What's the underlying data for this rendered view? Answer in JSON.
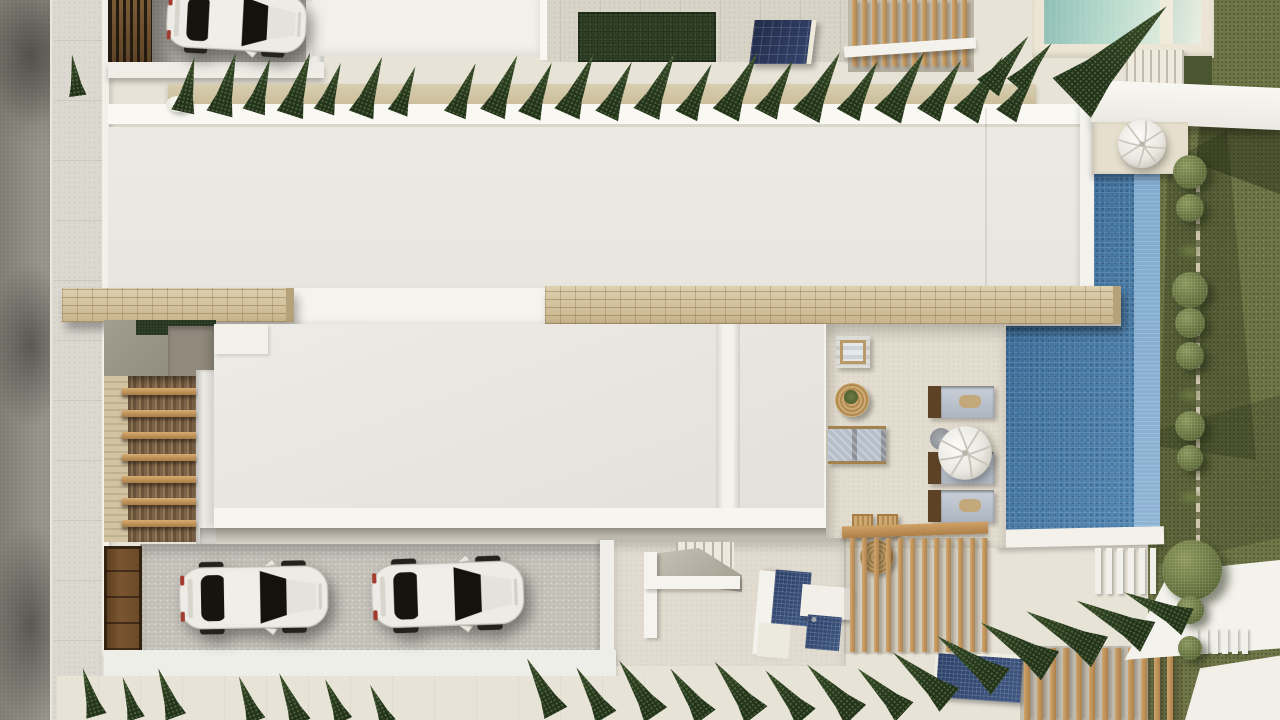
{
  "scene_type": "aerial-architectural-render",
  "palette": {
    "cream": "#e8e3d7",
    "road": "#8d8a81",
    "sidewalk": "#dcd9d1",
    "white": "#f5f3ee",
    "roof": "#ebe9e3",
    "parapet": "#f9f8f4",
    "stone": "#d9cca9",
    "stoneLine": "#a98e66",
    "wood": "#c89e68",
    "pool": "#4a7ba9",
    "poolLight": "#7fa9cd",
    "poolTop": "#b7dacd",
    "lawn": "#6e7546",
    "lawnDark": "#4b5630",
    "turf": "#33432a",
    "cypress": "#2c3f21",
    "bush": "#5f6c3a",
    "solar": "#283457",
    "glass": "#17150f",
    "carBody": "#edebe6",
    "mosaicDark": "#32486f",
    "floorA": "#c7c4bc",
    "floorB": "#b7b4ac",
    "terra": "#e3ddcf"
  },
  "inventory": {
    "cars_white": 3,
    "pools": 2,
    "spa_water_features": 2,
    "sun_loungers": 3,
    "closed_umbrellas": 2,
    "pergolas": 3,
    "cypress_trees_top": 26,
    "cypress_trees_bottom": 21,
    "round_bushes": 10
  },
  "road_shadows": [
    {
      "y": "-20px",
      "h": "150px"
    },
    {
      "y": "260px",
      "h": "170px"
    },
    {
      "y": "520px",
      "h": "210px"
    }
  ],
  "sidewalk_lines": [
    {
      "y": "40px"
    },
    {
      "y": "100px"
    },
    {
      "y": "160px"
    },
    {
      "y": "220px"
    },
    {
      "y": "280px"
    },
    {
      "y": "340px"
    },
    {
      "y": "400px"
    },
    {
      "y": "460px"
    },
    {
      "y": "520px"
    },
    {
      "y": "580px"
    },
    {
      "y": "640px"
    },
    {
      "y": "700px"
    }
  ],
  "garage_slats": [
    {
      "x": "112px"
    },
    {
      "x": "119px"
    },
    {
      "x": "126px"
    },
    {
      "x": "133px"
    },
    {
      "x": "140px"
    },
    {
      "x": "147px"
    }
  ],
  "courtyard_tiles": [
    {
      "x": "560px"
    },
    {
      "x": "600px"
    },
    {
      "x": "640px"
    },
    {
      "x": "680px"
    },
    {
      "x": "720px"
    },
    {
      "x": "760px"
    },
    {
      "x": "800px"
    },
    {
      "x": "840px"
    }
  ],
  "slats_pergola_top": [
    {
      "x": "852px"
    },
    {
      "x": "862px"
    },
    {
      "x": "872px"
    },
    {
      "x": "882px"
    },
    {
      "x": "892px"
    },
    {
      "x": "902px"
    },
    {
      "x": "912px"
    },
    {
      "x": "922px"
    },
    {
      "x": "932px"
    },
    {
      "x": "942px"
    },
    {
      "x": "952px"
    },
    {
      "x": "962px"
    }
  ],
  "beams_left": [
    {
      "y": "388px"
    },
    {
      "y": "410px"
    },
    {
      "y": "432px"
    },
    {
      "y": "454px"
    },
    {
      "y": "476px"
    },
    {
      "y": "498px"
    },
    {
      "y": "520px"
    }
  ],
  "loungers": [
    {
      "y": "386px"
    },
    {
      "y": "452px"
    },
    {
      "y": "490px"
    }
  ],
  "baskets": [
    {
      "x": "852px"
    },
    {
      "x": "877px"
    }
  ],
  "gate_planks": [
    {
      "y": "570px"
    },
    {
      "y": "596px"
    },
    {
      "y": "622px"
    },
    {
      "y": "648px"
    }
  ],
  "cars": [
    {
      "x": "168px",
      "y": "558px",
      "w": "168px",
      "r": "-1deg"
    },
    {
      "x": "360px",
      "y": "554px",
      "w": "172px",
      "r": "-2deg"
    },
    {
      "x": "156px",
      "y": "-16px",
      "w": "158px",
      "r": "3deg"
    }
  ],
  "umbrellas": [
    {
      "x": "936px",
      "y": "424px",
      "s": "58px",
      "r": "-15deg"
    },
    {
      "x": "1116px",
      "y": "118px",
      "s": "52px",
      "r": "10deg"
    }
  ],
  "slats_pergola_bottom": [
    {
      "x": "850px"
    },
    {
      "x": "862px"
    },
    {
      "x": "874px"
    },
    {
      "x": "886px"
    },
    {
      "x": "898px"
    },
    {
      "x": "910px"
    },
    {
      "x": "922px"
    },
    {
      "x": "934px"
    },
    {
      "x": "946px"
    },
    {
      "x": "958px"
    },
    {
      "x": "970px"
    },
    {
      "x": "982px"
    }
  ],
  "slats_fence": [
    {
      "x": "1024px"
    },
    {
      "x": "1037px"
    },
    {
      "x": "1050px"
    },
    {
      "x": "1063px"
    },
    {
      "x": "1076px"
    },
    {
      "x": "1089px"
    },
    {
      "x": "1102px"
    },
    {
      "x": "1115px"
    },
    {
      "x": "1128px"
    },
    {
      "x": "1141px"
    },
    {
      "x": "1154px"
    },
    {
      "x": "1167px"
    }
  ],
  "balusters_a": [
    {
      "x": "1095px"
    },
    {
      "x": "1106px"
    },
    {
      "x": "1117px"
    },
    {
      "x": "1128px"
    },
    {
      "x": "1139px"
    },
    {
      "x": "1150px"
    }
  ],
  "balusters_b": [
    {
      "x": "1192px"
    },
    {
      "x": "1202px"
    },
    {
      "x": "1212px"
    },
    {
      "x": "1222px"
    },
    {
      "x": "1232px"
    },
    {
      "x": "1242px"
    }
  ],
  "bushes": [
    {
      "y": "172px",
      "d": "34px"
    },
    {
      "y": "208px",
      "d": "28px"
    },
    {
      "y": "290px",
      "d": "36px"
    },
    {
      "y": "323px",
      "d": "30px"
    },
    {
      "y": "356px",
      "d": "28px"
    },
    {
      "y": "426px",
      "d": "30px"
    },
    {
      "y": "458px",
      "d": "26px"
    },
    {
      "y": "610px",
      "d": "28px"
    },
    {
      "y": "648px",
      "d": "24px"
    }
  ],
  "tufts": [
    {
      "y": "242px"
    },
    {
      "y": "386px"
    },
    {
      "y": "488px"
    }
  ],
  "top_trees": [
    {
      "x": "78px",
      "b": "96px",
      "h": "42px",
      "r": "-8deg"
    },
    {
      "x": "183px",
      "b": "112px",
      "h": "56px",
      "r": "12deg"
    },
    {
      "x": "219px",
      "b": "114px",
      "h": "64px",
      "r": "15deg"
    },
    {
      "x": "254px",
      "b": "112px",
      "h": "56px",
      "r": "17deg"
    },
    {
      "x": "290px",
      "b": "115px",
      "h": "66px",
      "r": "18deg"
    },
    {
      "x": "324px",
      "b": "112px",
      "h": "52px",
      "r": "19deg"
    },
    {
      "x": "361px",
      "b": "115px",
      "h": "62px",
      "r": "20deg"
    },
    {
      "x": "397px",
      "b": "113px",
      "h": "50px",
      "r": "21deg"
    },
    {
      "x": "455px",
      "b": "115px",
      "h": "56px",
      "r": "22deg"
    },
    {
      "x": "492px",
      "b": "114px",
      "h": "64px",
      "r": "23deg"
    },
    {
      "x": "529px",
      "b": "116px",
      "h": "58px",
      "r": "23deg"
    },
    {
      "x": "567px",
      "b": "114px",
      "h": "66px",
      "r": "24deg"
    },
    {
      "x": "607px",
      "b": "116px",
      "h": "60px",
      "r": "25deg"
    },
    {
      "x": "646px",
      "b": "114px",
      "h": "68px",
      "r": "25deg"
    },
    {
      "x": "686px",
      "b": "116px",
      "h": "58px",
      "r": "26deg"
    },
    {
      "x": "726px",
      "b": "115px",
      "h": "70px",
      "r": "27deg"
    },
    {
      "x": "766px",
      "b": "114px",
      "h": "60px",
      "r": "27deg"
    },
    {
      "x": "806px",
      "b": "116px",
      "h": "72px",
      "r": "28deg"
    },
    {
      "x": "848px",
      "b": "115px",
      "h": "62px",
      "r": "29deg"
    },
    {
      "x": "888px",
      "b": "116px",
      "h": "74px",
      "r": "30deg"
    },
    {
      "x": "928px",
      "b": "115px",
      "h": "64px",
      "r": "31deg"
    },
    {
      "x": "966px",
      "b": "116px",
      "h": "70px",
      "r": "32deg"
    },
    {
      "x": "1006px",
      "b": "116px",
      "h": "58px",
      "r": "33deg"
    },
    {
      "x": "988px",
      "b": "88px",
      "h": "66px",
      "r": "38deg"
    },
    {
      "x": "1016px",
      "b": "86px",
      "h": "56px",
      "r": "40deg"
    },
    {
      "x": "1072px",
      "b": "98px",
      "h": "132px",
      "r": "46deg"
    }
  ],
  "bottom_trees": [
    {
      "x": "96px",
      "b": "716px",
      "h": "50px",
      "r": "-16deg"
    },
    {
      "x": "136px",
      "b": "719px",
      "h": "44px",
      "r": "-18deg"
    },
    {
      "x": "176px",
      "b": "717px",
      "h": "52px",
      "r": "-20deg"
    },
    {
      "x": "256px",
      "b": "721px",
      "h": "48px",
      "r": "-21deg"
    },
    {
      "x": "300px",
      "b": "723px",
      "h": "54px",
      "r": "-23deg"
    },
    {
      "x": "344px",
      "b": "721px",
      "h": "46px",
      "r": "-24deg"
    },
    {
      "x": "388px",
      "b": "723px",
      "h": "42px",
      "r": "-25deg"
    },
    {
      "x": "556px",
      "b": "713px",
      "h": "62px",
      "r": "-28deg"
    },
    {
      "x": "606px",
      "b": "717px",
      "h": "58px",
      "r": "-31deg"
    },
    {
      "x": "656px",
      "b": "715px",
      "h": "66px",
      "r": "-34deg"
    },
    {
      "x": "706px",
      "b": "717px",
      "h": "60px",
      "r": "-36deg"
    },
    {
      "x": "756px",
      "b": "715px",
      "h": "68px",
      "r": "-38deg"
    },
    {
      "x": "806px",
      "b": "717px",
      "h": "62px",
      "r": "-41deg"
    },
    {
      "x": "856px",
      "b": "715px",
      "h": "70px",
      "r": "-44deg"
    },
    {
      "x": "904px",
      "b": "712px",
      "h": "64px",
      "r": "-47deg"
    },
    {
      "x": "950px",
      "b": "700px",
      "h": "74px",
      "r": "-50deg"
    },
    {
      "x": "1000px",
      "b": "682px",
      "h": "78px",
      "r": "-54deg"
    },
    {
      "x": "1050px",
      "b": "666px",
      "h": "82px",
      "r": "-58deg"
    },
    {
      "x": "1100px",
      "b": "652px",
      "h": "84px",
      "r": "-61deg"
    },
    {
      "x": "1148px",
      "b": "637px",
      "h": "80px",
      "r": "-63deg"
    },
    {
      "x": "1188px",
      "b": "622px",
      "h": "70px",
      "r": "-65deg"
    }
  ],
  "treads_tr_count": 7,
  "treads_b_count": 6
}
